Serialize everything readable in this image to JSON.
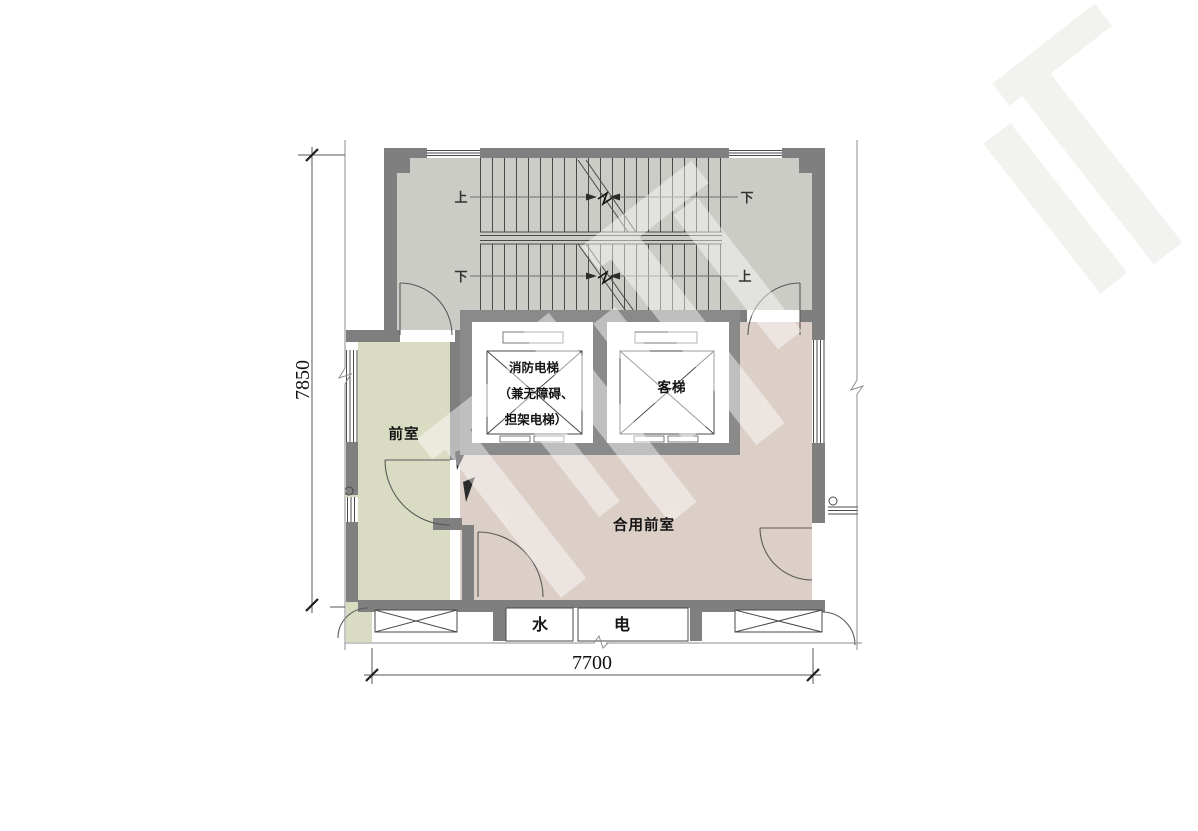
{
  "floor_plan": {
    "rooms": {
      "anteroom": "前室",
      "shared_anteroom": "合用前室",
      "water_shaft": "水",
      "electric_shaft": "电"
    },
    "elevators": {
      "fire_line1": "消防电梯",
      "fire_line2": "（兼无障碍、",
      "fire_line3": "担架电梯）",
      "passenger": "客梯"
    },
    "stairs": {
      "flight1_left": "上",
      "flight1_right": "下",
      "flight2_left": "下",
      "flight2_right": "上"
    },
    "dimensions": {
      "vertical": "7850",
      "horizontal": "7700"
    },
    "colors": {
      "wall": "#7f7f7f",
      "stair_fill": "#cbccc5",
      "anteroom_fill": "#d9dbc2",
      "shared_anteroom_fill": "#dccfc7",
      "line": "#4a4a4a"
    }
  }
}
